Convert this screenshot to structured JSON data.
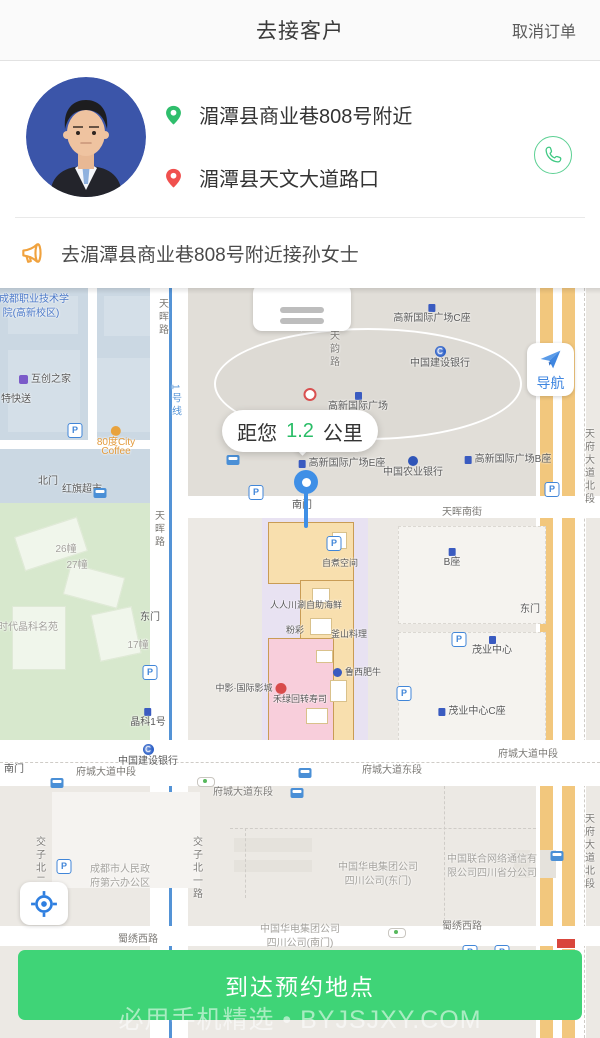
{
  "header": {
    "title": "去接客户",
    "cancel_label": "取消订单"
  },
  "customer": {
    "pickup_address": "湄潭县商业巷808号附近",
    "dropoff_address": "湄潭县天文大道路口"
  },
  "notice": {
    "text": "去湄潭县商业巷808号附近接孙女士"
  },
  "map": {
    "distance": {
      "prefix": "距您",
      "value": "1.2",
      "unit": "公里"
    },
    "nav_label": "导航",
    "labels": [
      {
        "t": "成都职业技术学",
        "x": 34,
        "y": 6,
        "c": "blue"
      },
      {
        "t": "院(高新校区)",
        "x": 31,
        "y": 20,
        "c": "blue"
      },
      {
        "t": "互创之家",
        "x": 45,
        "y": 86,
        "c": "dark",
        "i": "purple",
        "ip": "left"
      },
      {
        "t": "特快送",
        "x": 16,
        "y": 106,
        "c": "dark"
      },
      {
        "t": "80度City",
        "x": 116,
        "y": 138,
        "c": "orange",
        "i": "coffee"
      },
      {
        "t": "Coffee",
        "x": 116,
        "y": 158,
        "c": "orange"
      },
      {
        "t": "北门",
        "x": 48,
        "y": 188,
        "c": "dark"
      },
      {
        "t": "红旗超市",
        "x": 82,
        "y": 196,
        "c": "dark"
      },
      {
        "t": "天晖路",
        "x": 163,
        "y": 10,
        "c": "road",
        "v": 1
      },
      {
        "t": "天晖路",
        "x": 159,
        "y": 222,
        "c": "road",
        "v": 1
      },
      {
        "t": "1号线",
        "x": 176,
        "y": 96,
        "c": "metro",
        "v": 1
      },
      {
        "t": "26幢",
        "x": 66,
        "y": 256,
        "c": "faint"
      },
      {
        "t": "27幢",
        "x": 77,
        "y": 272,
        "c": "faint"
      },
      {
        "t": "时代晶科名苑",
        "x": 28,
        "y": 334,
        "c": "faint"
      },
      {
        "t": "东门",
        "x": 150,
        "y": 324,
        "c": "dark"
      },
      {
        "t": "17幢",
        "x": 138,
        "y": 352,
        "c": "faint"
      },
      {
        "t": "晶科1号",
        "x": 148,
        "y": 420,
        "c": "dark",
        "i": "bldg"
      },
      {
        "t": "中国建设银行",
        "x": 148,
        "y": 456,
        "c": "dark",
        "i": "bankc"
      },
      {
        "t": "南门",
        "x": 14,
        "y": 476,
        "c": "dark"
      },
      {
        "t": "交子北二路",
        "x": 40,
        "y": 548,
        "c": "road",
        "v": 1
      },
      {
        "t": "交子北一路",
        "x": 197,
        "y": 548,
        "c": "road",
        "v": 1
      },
      {
        "t": "成都市人民政",
        "x": 120,
        "y": 576,
        "c": "faint"
      },
      {
        "t": "府第六办公区",
        "x": 120,
        "y": 590,
        "c": "faint"
      },
      {
        "t": "高新国际广场C座",
        "x": 432,
        "y": 16,
        "c": "dark",
        "i": "bldg"
      },
      {
        "t": "中国建设银行",
        "x": 440,
        "y": 58,
        "c": "dark",
        "i": "bankc"
      },
      {
        "t": "天韵路",
        "x": 334,
        "y": 42,
        "c": "road",
        "v": 1
      },
      {
        "t": "高新国际广场",
        "x": 358,
        "y": 104,
        "c": "dark",
        "i": "bldg"
      },
      {
        "t": "",
        "x": 310,
        "y": 100,
        "i": "redb"
      },
      {
        "t": "高新国际广场E座",
        "x": 342,
        "y": 170,
        "c": "dark",
        "i": "bldg",
        "ip": "left"
      },
      {
        "t": "中国农业银行",
        "x": 413,
        "y": 168,
        "c": "dark",
        "i": "bank"
      },
      {
        "t": "高新国际广场B座",
        "x": 508,
        "y": 166,
        "c": "dark",
        "i": "bldg",
        "ip": "left"
      },
      {
        "t": "南门",
        "x": 302,
        "y": 212,
        "c": "dark"
      },
      {
        "t": "天晖南街",
        "x": 462,
        "y": 219,
        "c": "road"
      },
      {
        "t": "B座",
        "x": 452,
        "y": 260,
        "c": "dark",
        "i": "bldg"
      },
      {
        "t": "东门",
        "x": 530,
        "y": 316,
        "c": "dark"
      },
      {
        "t": "茂业中心",
        "x": 492,
        "y": 348,
        "c": "dark",
        "i": "bldg"
      },
      {
        "t": "茂业中心C座",
        "x": 472,
        "y": 418,
        "c": "dark",
        "i": "bldg",
        "ip": "left"
      },
      {
        "t": "自煮空间",
        "x": 340,
        "y": 270,
        "c": "dark",
        "s": 9
      },
      {
        "t": "人人川涮自助海鲜",
        "x": 306,
        "y": 312,
        "c": "dark",
        "s": 9
      },
      {
        "t": "粉彩",
        "x": 295,
        "y": 337,
        "c": "dark",
        "s": 9
      },
      {
        "t": "釜山料理",
        "x": 349,
        "y": 341,
        "c": "dark",
        "s": 9
      },
      {
        "t": "鲁西肥牛",
        "x": 357,
        "y": 379,
        "c": "dark",
        "s": 9,
        "i": "shop",
        "ip": "left"
      },
      {
        "t": "中影·国际影城",
        "x": 251,
        "y": 395,
        "c": "dark",
        "s": 9,
        "i": "redc",
        "ip": "right"
      },
      {
        "t": "禾绿回转寿司",
        "x": 300,
        "y": 406,
        "c": "dark",
        "s": 9
      },
      {
        "t": "府城大道中段",
        "x": 106,
        "y": 479,
        "c": "road"
      },
      {
        "t": "府城大道东段",
        "x": 243,
        "y": 499,
        "c": "road"
      },
      {
        "t": "府城大道东段",
        "x": 392,
        "y": 477,
        "c": "road"
      },
      {
        "t": "府城大道中段",
        "x": 528,
        "y": 461,
        "c": "road"
      },
      {
        "t": "中国华电集团公司",
        "x": 378,
        "y": 574,
        "c": "faint"
      },
      {
        "t": "四川公司(东门)",
        "x": 378,
        "y": 588,
        "c": "faint"
      },
      {
        "t": "中国联合网络通信有",
        "x": 492,
        "y": 566,
        "c": "faint"
      },
      {
        "t": "限公司四川省分公司",
        "x": 492,
        "y": 580,
        "c": "faint"
      },
      {
        "t": "中国华电集团公司",
        "x": 300,
        "y": 636,
        "c": "faint"
      },
      {
        "t": "四川公司(南门)",
        "x": 300,
        "y": 650,
        "c": "faint"
      },
      {
        "t": "蜀绣西路",
        "x": 138,
        "y": 646,
        "c": "road"
      },
      {
        "t": "蜀绣西路",
        "x": 462,
        "y": 633,
        "c": "road"
      },
      {
        "t": "天府大道北段",
        "x": 589,
        "y": 140,
        "c": "road",
        "v": 1
      },
      {
        "t": "天府大道北段",
        "x": 589,
        "y": 525,
        "c": "road",
        "v": 1
      }
    ],
    "parking_icons": [
      [
        75,
        135
      ],
      [
        256,
        197
      ],
      [
        552,
        194
      ],
      [
        334,
        248
      ],
      [
        150,
        377
      ],
      [
        459,
        344
      ],
      [
        404,
        398
      ],
      [
        64,
        571
      ],
      [
        470,
        657
      ],
      [
        502,
        657
      ]
    ],
    "bus_icons": [
      [
        100,
        200
      ],
      [
        233,
        167
      ],
      [
        57,
        490
      ],
      [
        305,
        480
      ],
      [
        297,
        500
      ],
      [
        557,
        563
      ]
    ],
    "signal_icons": [
      [
        206,
        489
      ],
      [
        397,
        640
      ]
    ]
  },
  "footer": {
    "action_label": "到达预约地点",
    "watermark": "必用手机精选 • BYJSJXY.COM"
  },
  "colors": {
    "accent_green": "#3FD477",
    "pin_green": "#2FBE6C",
    "pin_red": "#F0504E",
    "nav_blue": "#3F86E0",
    "notice_orange": "#F0A23E"
  }
}
